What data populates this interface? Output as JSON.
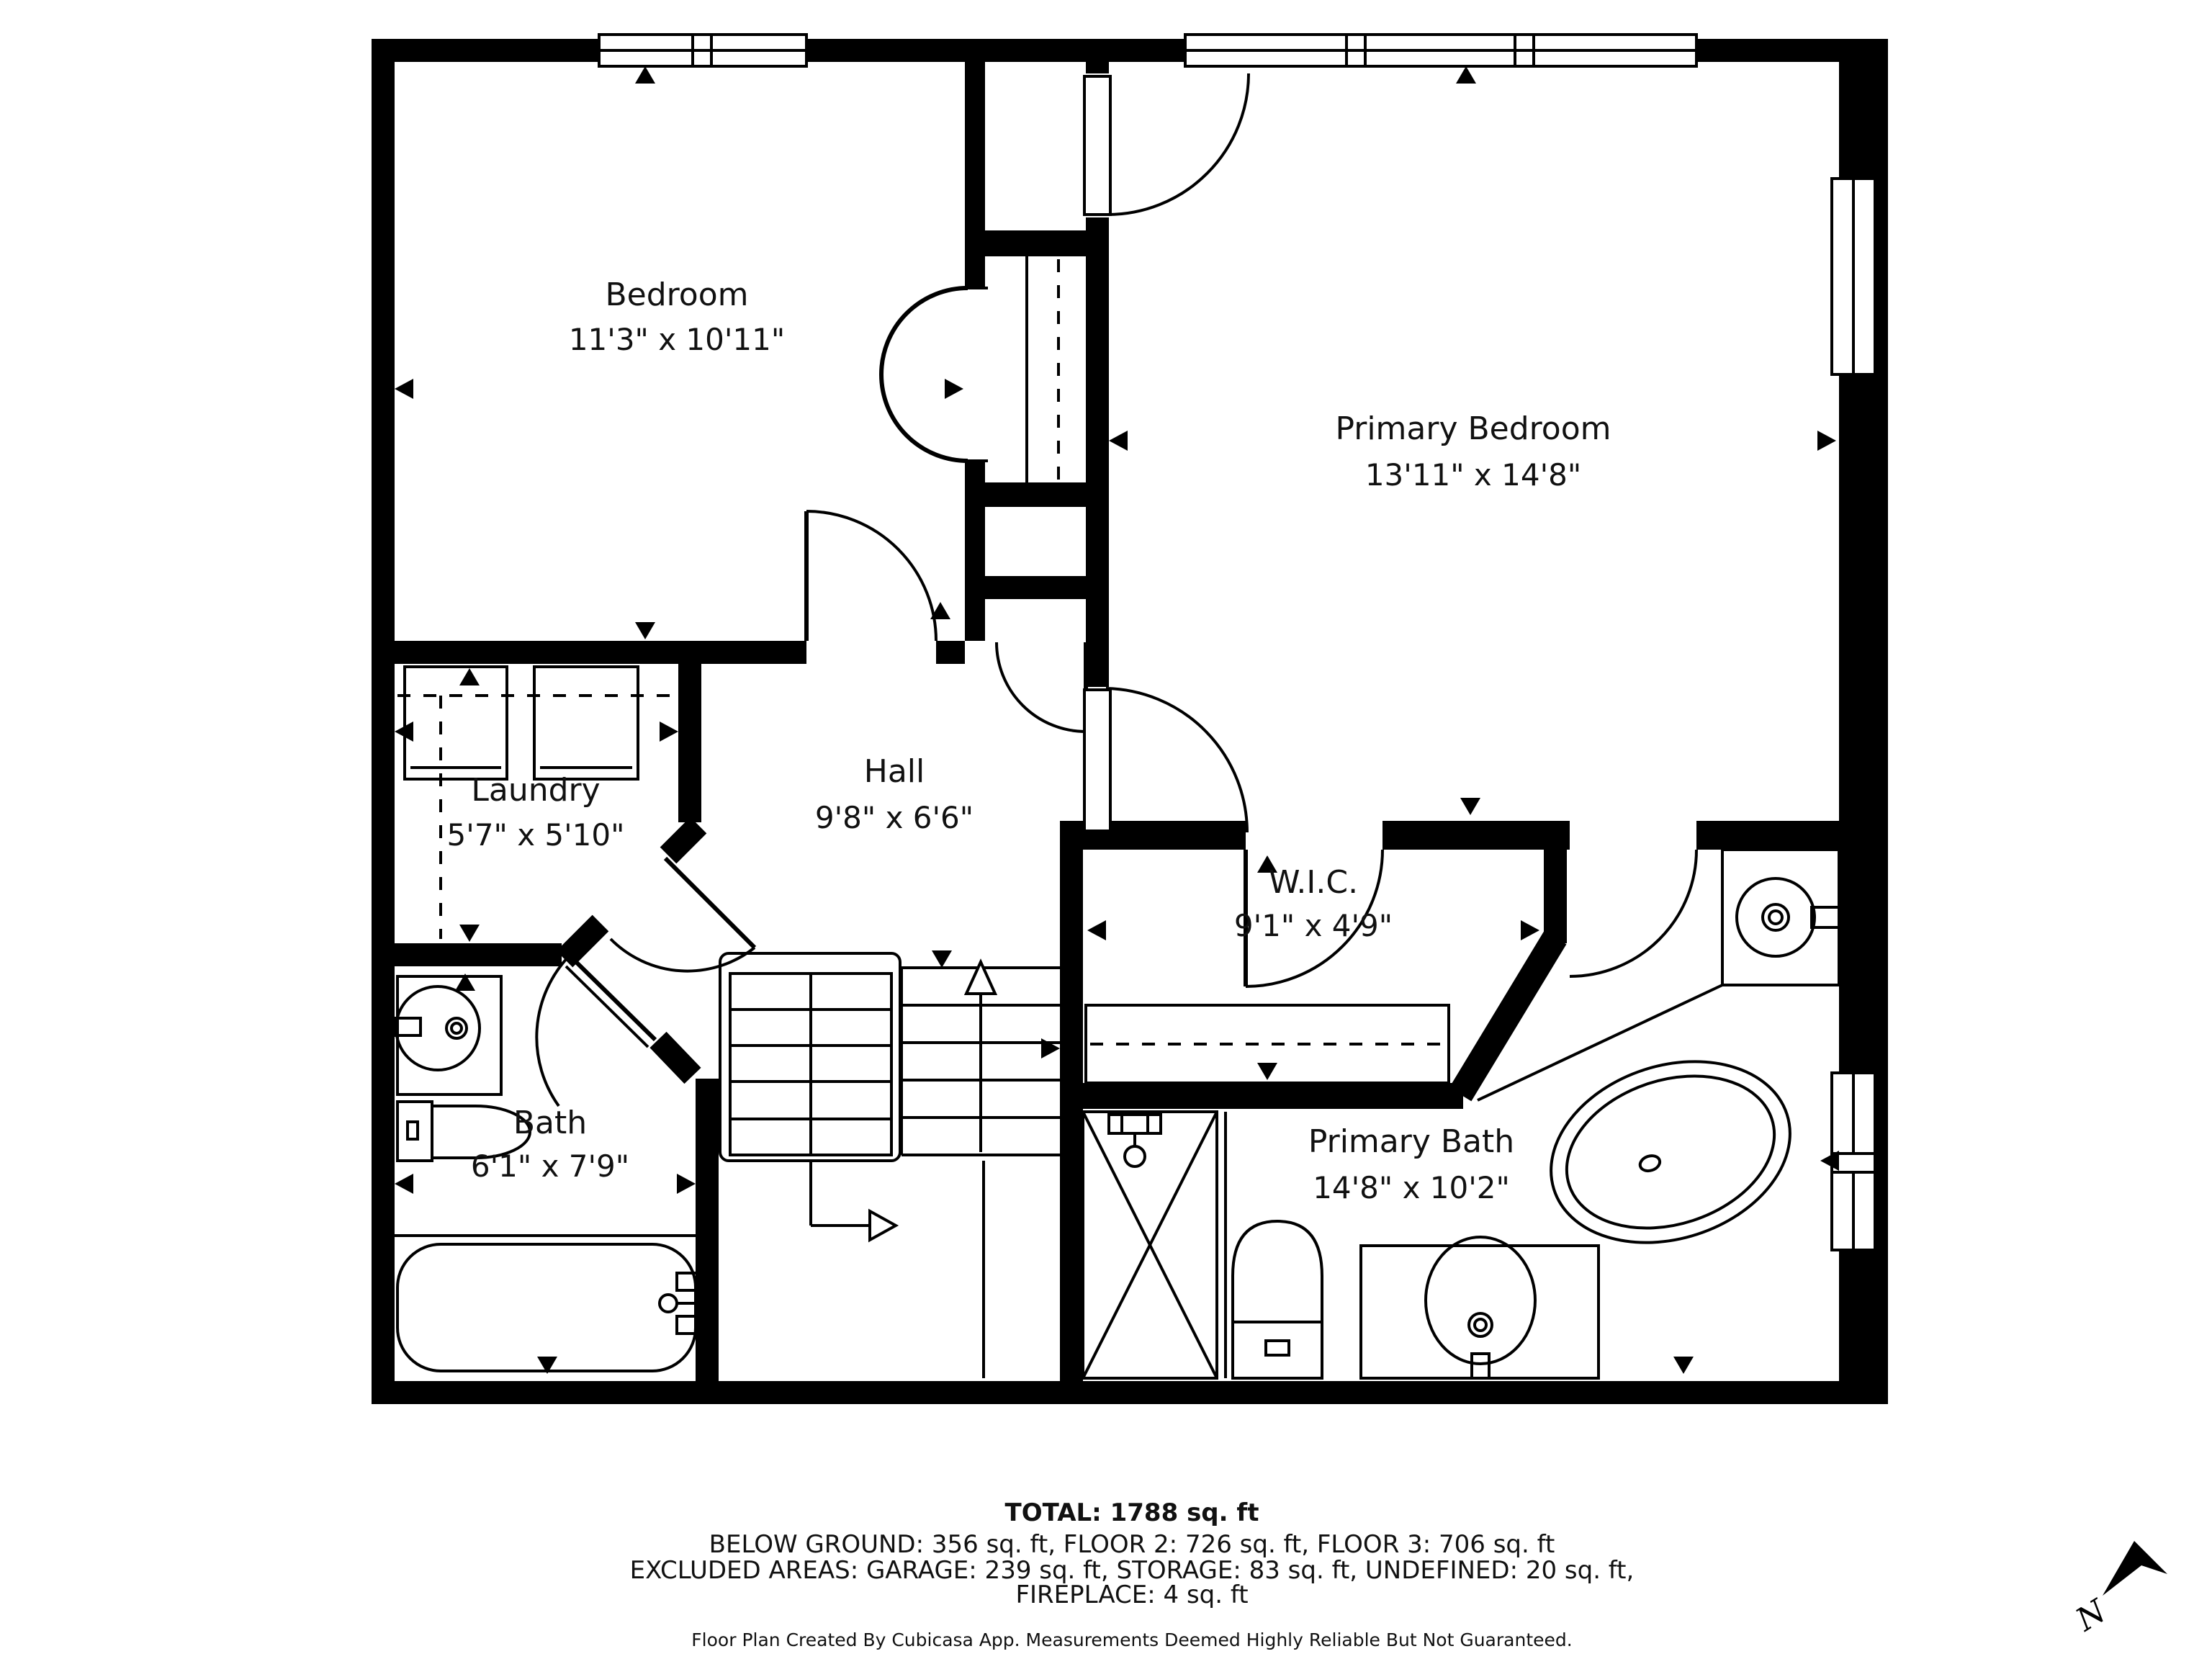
{
  "plan": {
    "rooms": [
      {
        "name": "Bedroom",
        "dims": "11'3\" x 10'11\""
      },
      {
        "name": "Primary Bedroom",
        "dims": "13'11\" x 14'8\""
      },
      {
        "name": "Laundry",
        "dims": "5'7\" x 5'10\""
      },
      {
        "name": "Hall",
        "dims": "9'8\" x 6'6\""
      },
      {
        "name": "W.I.C.",
        "dims": "9'1\" x 4'9\""
      },
      {
        "name": "Bath",
        "dims": "6'1\" x 7'9\""
      },
      {
        "name": "Primary Bath",
        "dims": "14'8\" x 10'2\""
      }
    ],
    "compass_label": "N"
  },
  "footer": {
    "total": "TOTAL: 1788 sq. ft",
    "line1": "BELOW GROUND: 356 sq. ft, FLOOR 2: 726 sq. ft, FLOOR 3: 706 sq. ft",
    "line2": "EXCLUDED AREAS: GARAGE: 239 sq. ft, STORAGE: 83 sq. ft, UNDEFINED: 20 sq. ft,",
    "line3": "FIREPLACE: 4 sq. ft",
    "disclaimer": "Floor Plan Created By Cubicasa App. Measurements Deemed Highly Reliable But Not Guaranteed."
  },
  "colors": {
    "wall": "#000000",
    "background": "#ffffff"
  }
}
